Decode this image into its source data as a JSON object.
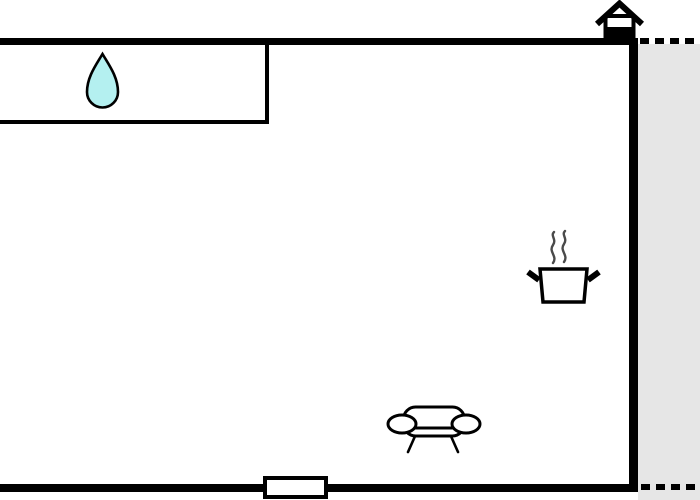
{
  "floor_plan": {
    "kind": "apartment-floor-plan",
    "colors": {
      "background": "#ffffff",
      "wall": "#000000",
      "outline": "#000000",
      "terrace_fill": "#e6e6e6",
      "water_drop_fill": "#b4f0f0",
      "steam": "#4a4a4a",
      "fixture_fill": "#ffffff"
    },
    "icons": [
      "entrance-house-icon",
      "water-drop-icon",
      "cooking-pot-icon",
      "sofa-icon",
      "window-symbol"
    ]
  }
}
